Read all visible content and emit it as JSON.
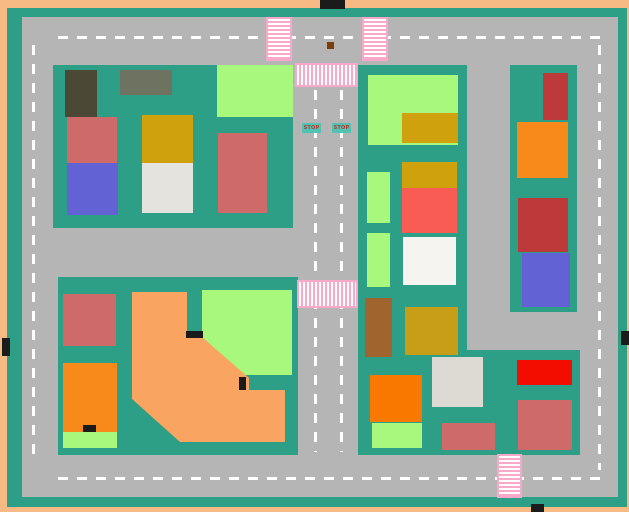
{
  "scene": {
    "description": "Top-down toy town road map with city blocks, buildings, crosswalks and stop signs",
    "colors": {
      "border": "#F8BA85",
      "block": "#2D9F87",
      "road": "#B5B5B5",
      "dash": "#FFFFFF",
      "crosswalk_pink": "#F8A8C8",
      "crosswalk_white": "#FFFFFF",
      "stop_bg": "#52C3B2",
      "stop_text": "#B03A30",
      "marker_black": "#1B1B1B",
      "marker_brown": "#7A3D0B"
    },
    "blocks": [
      {
        "n": "city-block-top-left",
        "x": 53,
        "y": 65,
        "w": 240,
        "h": 163
      },
      {
        "n": "city-block-bottom-left",
        "x": 58,
        "y": 277,
        "w": 240,
        "h": 178
      },
      {
        "n": "city-block-center-vertical",
        "x": 358,
        "y": 65,
        "w": 109,
        "h": 390
      },
      {
        "n": "city-block-bottom-right",
        "x": 358,
        "y": 350,
        "w": 222,
        "h": 105
      },
      {
        "n": "city-block-right",
        "x": 510,
        "y": 65,
        "w": 67,
        "h": 247
      }
    ],
    "lane_lines": [
      {
        "n": "lane-line-top-road",
        "dir": "h",
        "x": 58,
        "y": 36,
        "w": 542,
        "h": 3
      },
      {
        "n": "lane-line-bottom-road",
        "dir": "h",
        "x": 58,
        "y": 477,
        "w": 542,
        "h": 3
      },
      {
        "n": "lane-line-left-road",
        "dir": "v",
        "x": 32,
        "y": 45,
        "w": 3,
        "h": 417
      },
      {
        "n": "lane-line-right-road",
        "dir": "v",
        "x": 598,
        "y": 45,
        "w": 3,
        "h": 425
      },
      {
        "n": "lane-line-center-road-left",
        "dir": "v",
        "x": 314,
        "y": 90,
        "w": 3,
        "h": 362
      },
      {
        "n": "lane-line-center-road-right",
        "dir": "v",
        "x": 340,
        "y": 90,
        "w": 3,
        "h": 362
      }
    ],
    "crosswalks": [
      {
        "n": "crosswalk-top-left",
        "dir": "h",
        "x": 266,
        "y": 17,
        "w": 26,
        "h": 44
      },
      {
        "n": "crosswalk-top-right",
        "dir": "h",
        "x": 362,
        "y": 17,
        "w": 26,
        "h": 44
      },
      {
        "n": "crosswalk-center-top",
        "dir": "v",
        "x": 295,
        "y": 63,
        "w": 63,
        "h": 24
      },
      {
        "n": "crosswalk-center-middle",
        "dir": "v",
        "x": 297,
        "y": 280,
        "w": 61,
        "h": 28
      },
      {
        "n": "crosswalk-bottom",
        "dir": "h",
        "x": 497,
        "y": 454,
        "w": 25,
        "h": 44
      }
    ],
    "buildings": [
      {
        "n": "building-dark-olive",
        "x": 65,
        "y": 70,
        "w": 32,
        "h": 47,
        "c": "#4B4836"
      },
      {
        "n": "building-gray-olive",
        "x": 120,
        "y": 70,
        "w": 52,
        "h": 25,
        "c": "#6E7260"
      },
      {
        "n": "building-light-green",
        "x": 217,
        "y": 65,
        "w": 76,
        "h": 52,
        "c": "#A9F87E"
      },
      {
        "n": "building-rose",
        "x": 67,
        "y": 117,
        "w": 50,
        "h": 46,
        "c": "#CF6A6A"
      },
      {
        "n": "building-blue",
        "x": 67,
        "y": 163,
        "w": 51,
        "h": 52,
        "c": "#6262D4"
      },
      {
        "n": "building-gold",
        "x": 142,
        "y": 115,
        "w": 51,
        "h": 48,
        "c": "#CFA10D"
      },
      {
        "n": "building-light-gray",
        "x": 142,
        "y": 163,
        "w": 51,
        "h": 50,
        "c": "#E5E3DD"
      },
      {
        "n": "building-rose",
        "x": 218,
        "y": 133,
        "w": 49,
        "h": 80,
        "c": "#CF6A6A"
      },
      {
        "n": "building-rose",
        "x": 63,
        "y": 294,
        "w": 53,
        "h": 52,
        "c": "#CF6A6A"
      },
      {
        "n": "building-orange",
        "x": 63,
        "y": 363,
        "w": 54,
        "h": 69,
        "c": "#F8891B"
      },
      {
        "n": "building-light-green-strip",
        "x": 63,
        "y": 432,
        "w": 54,
        "h": 16,
        "c": "#A9F87E"
      },
      {
        "n": "building-light-green-large",
        "x": 202,
        "y": 290,
        "w": 90,
        "h": 85,
        "c": "#A9F87E"
      },
      {
        "n": "building-light-green",
        "x": 368,
        "y": 75,
        "w": 90,
        "h": 70,
        "c": "#A9F87E"
      },
      {
        "n": "building-gold",
        "x": 402,
        "y": 113,
        "w": 56,
        "h": 30,
        "c": "#CFA10D"
      },
      {
        "n": "building-gold",
        "x": 402,
        "y": 162,
        "w": 55,
        "h": 26,
        "c": "#CFA10D"
      },
      {
        "n": "building-coral",
        "x": 402,
        "y": 188,
        "w": 55,
        "h": 45,
        "c": "#F85C55"
      },
      {
        "n": "building-white",
        "x": 403,
        "y": 237,
        "w": 53,
        "h": 48,
        "c": "#F6F4F1"
      },
      {
        "n": "building-light-green-small",
        "x": 367,
        "y": 172,
        "w": 23,
        "h": 51,
        "c": "#A9F87E"
      },
      {
        "n": "building-light-green-small",
        "x": 367,
        "y": 233,
        "w": 23,
        "h": 54,
        "c": "#A9F87E"
      },
      {
        "n": "building-brown",
        "x": 365,
        "y": 298,
        "w": 27,
        "h": 59,
        "c": "#A0652F"
      },
      {
        "n": "building-dark-gold",
        "x": 405,
        "y": 307,
        "w": 53,
        "h": 48,
        "c": "#C79E17"
      },
      {
        "n": "building-light-gray",
        "x": 432,
        "y": 357,
        "w": 51,
        "h": 50,
        "c": "#DDDAD3"
      },
      {
        "n": "building-orange-vivid",
        "x": 370,
        "y": 375,
        "w": 52,
        "h": 47,
        "c": "#F87800"
      },
      {
        "n": "building-light-green",
        "x": 372,
        "y": 423,
        "w": 50,
        "h": 25,
        "c": "#A9F87E"
      },
      {
        "n": "building-bright-red",
        "x": 517,
        "y": 360,
        "w": 55,
        "h": 25,
        "c": "#F20D00"
      },
      {
        "n": "building-rose",
        "x": 518,
        "y": 400,
        "w": 54,
        "h": 50,
        "c": "#CF6A6A"
      },
      {
        "n": "building-rose",
        "x": 442,
        "y": 423,
        "w": 53,
        "h": 27,
        "c": "#CF6A6A"
      },
      {
        "n": "building-dark-red",
        "x": 543,
        "y": 73,
        "w": 25,
        "h": 47,
        "c": "#BE3A3A"
      },
      {
        "n": "building-orange",
        "x": 517,
        "y": 122,
        "w": 51,
        "h": 56,
        "c": "#F8891B"
      },
      {
        "n": "building-dark-red",
        "x": 518,
        "y": 198,
        "w": 50,
        "h": 54,
        "c": "#BE3A3A"
      },
      {
        "n": "building-blue",
        "x": 522,
        "y": 253,
        "w": 48,
        "h": 54,
        "c": "#6262D4"
      }
    ],
    "orange_polygon": {
      "points": "132,292 187,292 187,337 202,337 249,378 249,390 285,390 285,442 180,442 132,399",
      "color": "#F9A460"
    },
    "markers": [
      {
        "n": "car-marker-top-border",
        "x": 320,
        "y": 0,
        "w": 25,
        "h": 9,
        "c": "#1B1B1B"
      },
      {
        "n": "car-marker-left-border",
        "x": 2,
        "y": 338,
        "w": 8,
        "h": 18,
        "c": "#1B1B1B"
      },
      {
        "n": "car-marker-right-border",
        "x": 621,
        "y": 331,
        "w": 8,
        "h": 14,
        "c": "#1B1B1B"
      },
      {
        "n": "car-marker-bottom-border",
        "x": 531,
        "y": 504,
        "w": 13,
        "h": 8,
        "c": "#1B1B1B"
      },
      {
        "n": "black-bar-notch",
        "x": 186,
        "y": 331,
        "w": 17,
        "h": 7,
        "c": "#1B1B1B"
      },
      {
        "n": "black-bar-step",
        "x": 239,
        "y": 377,
        "w": 7,
        "h": 13,
        "c": "#1B1B1B"
      },
      {
        "n": "black-bar-orange-building",
        "x": 83,
        "y": 425,
        "w": 13,
        "h": 7,
        "c": "#1B1B1B"
      },
      {
        "n": "brown-dot-road",
        "x": 327,
        "y": 42,
        "w": 7,
        "h": 7,
        "c": "#7A3D0B"
      }
    ],
    "stop_signs": [
      {
        "label": "STOP",
        "x": 302,
        "y": 123,
        "w": 19,
        "h": 10
      },
      {
        "label": "STOP",
        "x": 332,
        "y": 123,
        "w": 19,
        "h": 10
      }
    ]
  }
}
